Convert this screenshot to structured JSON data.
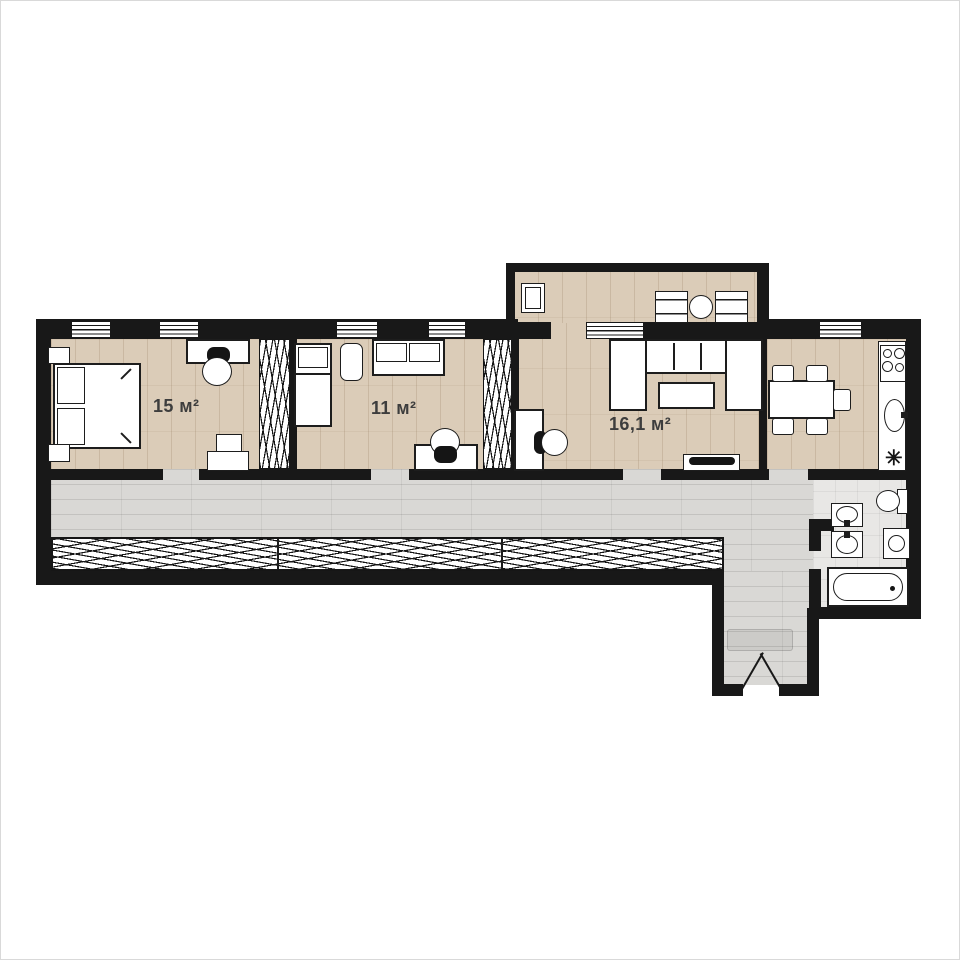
{
  "plan": {
    "rooms": [
      {
        "name": "bedroom",
        "area_label": "15 м²"
      },
      {
        "name": "bedroom-2",
        "area_label": "11 м²"
      },
      {
        "name": "living-room",
        "area_label": "16,1 м²"
      }
    ],
    "icons": {
      "kitchen_symbol": "✳"
    },
    "colors": {
      "wall": "#181818",
      "wood_floor": "#dbccb8",
      "laminate_floor": "#d9d8d5",
      "bath_floor": "#e8e7e5",
      "furniture_outline": "#1d1d1d",
      "label_text": "#3d3d3d",
      "background": "#ffffff"
    }
  }
}
